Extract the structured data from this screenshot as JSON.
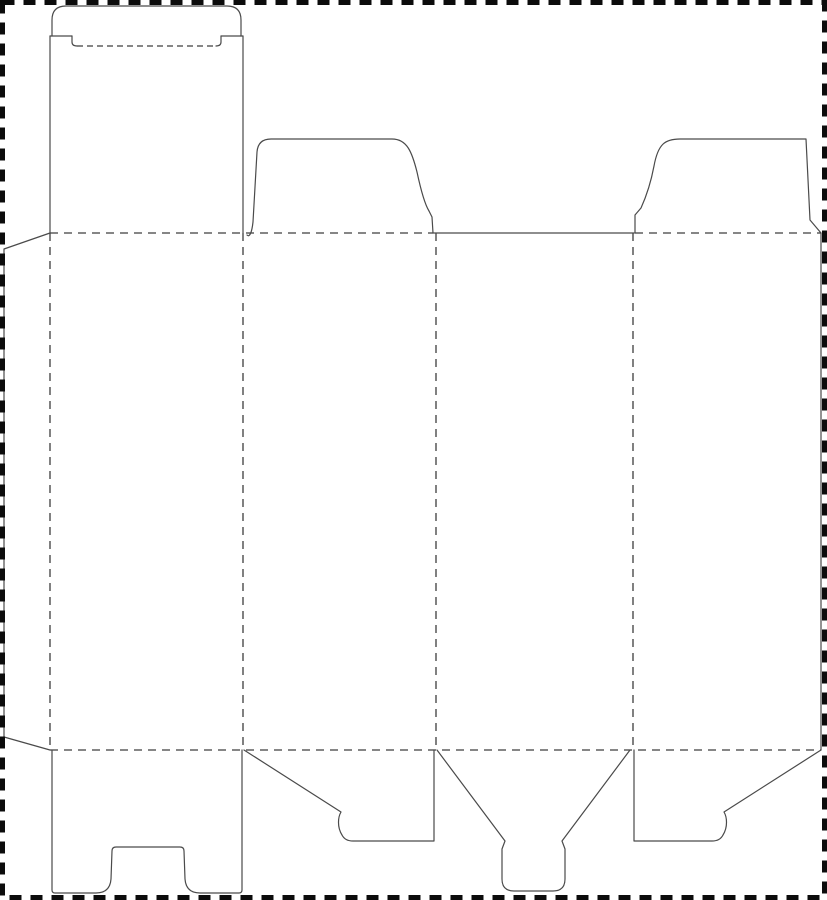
{
  "canvas": {
    "width": 827,
    "height": 900,
    "background_color": "#ffffff"
  },
  "styles": {
    "cut_line_color": "#4a4a4a",
    "cut_line_width": 1.2,
    "fold_line_color": "#3d3d3d",
    "fold_line_width": 1.3,
    "fold_dash": "8 6",
    "slit_fold_dash": "6 4",
    "border_color": "#0c0c0c",
    "border_width": 5,
    "border_dash": "12 9"
  },
  "dieline": {
    "border": {
      "name": "sheet-cut-boundary",
      "x": 2.5,
      "y": 2.5,
      "width": 822,
      "height": 895
    },
    "cuts": [
      {
        "name": "tuck-flap-outline",
        "d": "M 52 36 L 52 20 Q 52 6 66 6 L 227 6 Q 241 6 241 20 L 241 36"
      },
      {
        "name": "tuck-flap-left-shoulder",
        "d": "M 50 36 L 72 36"
      },
      {
        "name": "tuck-flap-left-slit-hook",
        "d": "M 72 36 L 72 42 Q 72 46 77 46"
      },
      {
        "name": "tuck-flap-right-shoulder",
        "d": "M 243 36 L 221 36"
      },
      {
        "name": "tuck-flap-right-slit-hook",
        "d": "M 221 36 L 221 42 Q 221 46 216 46"
      },
      {
        "name": "lid-panel-left-edge",
        "d": "M 50 36 L 50 233"
      },
      {
        "name": "lid-panel-right-edge",
        "d": "M 243 36 L 243 233"
      },
      {
        "name": "glue-flap-outline",
        "d": "M 50 233 L 4 249 L 4 737 L 50 750"
      },
      {
        "name": "top-dust-flap-left-outline",
        "d": "M 247 235 C 250 238 252 231 253 222 L 257 152 Q 258 139 271 139 L 392 139 C 407 139 412 152 417 172 C 420 186 424 203 429 211 L 432 217 L 433 233"
      },
      {
        "name": "panel-3-top-edge",
        "d": "M 433 233 L 634 233"
      },
      {
        "name": "top-dust-flap-right-outline",
        "d": "M 635 233 L 635 215 L 641 208 C 646 197 651 182 654 166 C 658 144 665 139 680 139 L 806 139 L 810 220 L 821 233"
      },
      {
        "name": "panel-4-right-edge",
        "d": "M 821 233 L 821 750"
      },
      {
        "name": "bottom-lock-flap-outline",
        "d": "M 52 750 L 52 890 Q 52 893 55 893 L 96 893 Q 110 893 111 879 L 112 851 Q 112 847 116 847 L 180 847 Q 184 847 184 851 L 185 879 Q 186 893 200 893 L 239 893 Q 242 893 242 890 L 242 750"
      },
      {
        "name": "bottom-dust-flap-left-outline",
        "d": "M 244 750 L 341 812 C 338 817 337 827 342 835 Q 345 841 353 841 L 434 841 L 434 750"
      },
      {
        "name": "bottom-tongue-flap-outline",
        "d": "M 437 750 L 505 841 L 502 849 L 502 879 Q 502 891 514 891 L 553 891 Q 565 891 565 879 L 565 849 L 562 841 L 630 750"
      },
      {
        "name": "bottom-dust-flap-right-outline",
        "d": "M 634 750 L 634 841 L 712 841 Q 720 841 723 835 C 728 827 727 817 724 812 L 821 750"
      }
    ],
    "folds": [
      {
        "name": "tuck-flap-fold",
        "slit": true,
        "d": "M 77 46 L 216 46"
      },
      {
        "name": "top-fold-left-section",
        "slit": false,
        "d": "M 50 233 L 433 233"
      },
      {
        "name": "top-fold-right-section",
        "slit": false,
        "d": "M 635 233 L 821 233"
      },
      {
        "name": "bottom-fold",
        "slit": false,
        "d": "M 50 750 L 821 750"
      },
      {
        "name": "glue-flap-fold",
        "slit": false,
        "d": "M 50 233 L 50 750"
      },
      {
        "name": "fold-panel-1-2",
        "slit": false,
        "d": "M 243 233 L 243 750"
      },
      {
        "name": "fold-panel-2-3",
        "slit": false,
        "d": "M 436 233 L 436 750"
      },
      {
        "name": "fold-panel-3-4",
        "slit": false,
        "d": "M 633 233 L 633 750"
      }
    ]
  }
}
